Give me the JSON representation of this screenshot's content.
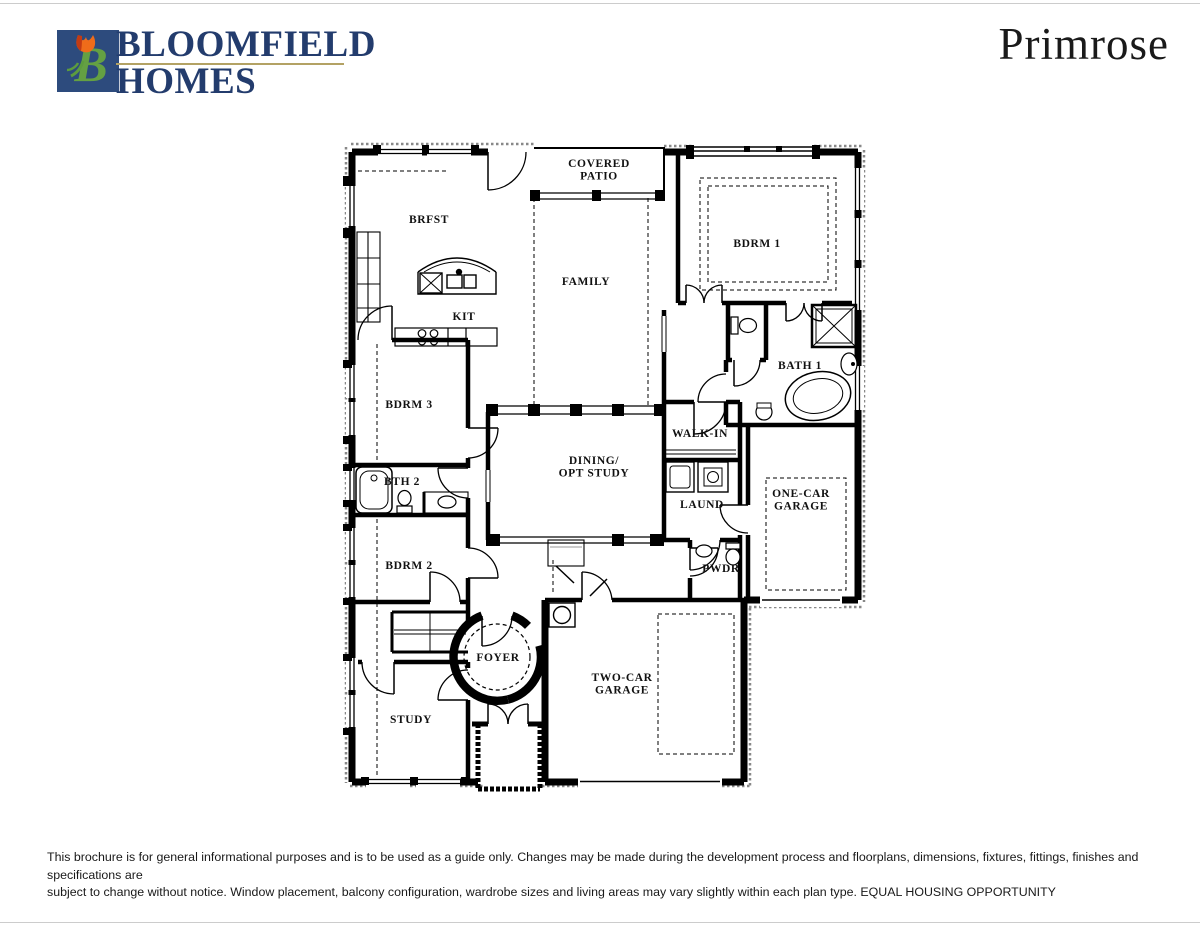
{
  "brand": {
    "line1": "BLOOMFIELD",
    "line2": "HOMES",
    "logo_letter": "B",
    "logo_icon": "tulip-b-monogram"
  },
  "plan": {
    "title": "Primrose"
  },
  "colors": {
    "brand_navy": "#233c6d",
    "logo_square_blue": "#2d4b7d",
    "logo_leaf_green": "#64a043",
    "logo_tulip_orange": "#ef6c1a",
    "logo_tulip_red": "#c23b14",
    "gold_rule": "#b3a264",
    "wall_black": "#000000",
    "paper_white": "#ffffff"
  },
  "floorplan": {
    "rooms": [
      {
        "id": "covered-patio",
        "label": "COVERED\nPATIO",
        "x": 599,
        "y": 167
      },
      {
        "id": "brfst",
        "label": "BRFST",
        "x": 429,
        "y": 223
      },
      {
        "id": "family",
        "label": "FAMILY",
        "x": 586,
        "y": 285
      },
      {
        "id": "bdrm-1",
        "label": "BDRM 1",
        "x": 757,
        "y": 247
      },
      {
        "id": "kit",
        "label": "KIT",
        "x": 464,
        "y": 320
      },
      {
        "id": "bdrm-3",
        "label": "BDRM 3",
        "x": 409,
        "y": 408
      },
      {
        "id": "bath-1",
        "label": "BATH 1",
        "x": 800,
        "y": 369
      },
      {
        "id": "walk-in",
        "label": "WALK-IN",
        "x": 700,
        "y": 437
      },
      {
        "id": "dining-opt-study",
        "label": "DINING/\nOPT STUDY",
        "x": 594,
        "y": 464
      },
      {
        "id": "bth-2",
        "label": "BTH 2",
        "x": 402,
        "y": 485
      },
      {
        "id": "laund",
        "label": "LAUND",
        "x": 702,
        "y": 508
      },
      {
        "id": "one-car-garage",
        "label": "ONE-CAR\nGARAGE",
        "x": 801,
        "y": 497
      },
      {
        "id": "bdrm-2",
        "label": "BDRM 2",
        "x": 409,
        "y": 569
      },
      {
        "id": "pwdr",
        "label": "PWDR",
        "x": 721,
        "y": 572
      },
      {
        "id": "foyer",
        "label": "FOYER",
        "x": 498,
        "y": 661
      },
      {
        "id": "two-car-garage",
        "label": "TWO-CAR\nGARAGE",
        "x": 622,
        "y": 681
      },
      {
        "id": "study",
        "label": "STUDY",
        "x": 411,
        "y": 723
      }
    ]
  },
  "footer": {
    "line1": "This brochure is for general informational purposes and is to be used as a guide only. Changes may be made during the development process and floorplans, dimensions, fixtures, fittings, finishes and specifications are",
    "line2": "subject to change without notice. Window placement, balcony configuration, wardrobe sizes and living areas may vary slightly within each plan type.  EQUAL HOUSING OPPORTUNITY"
  }
}
